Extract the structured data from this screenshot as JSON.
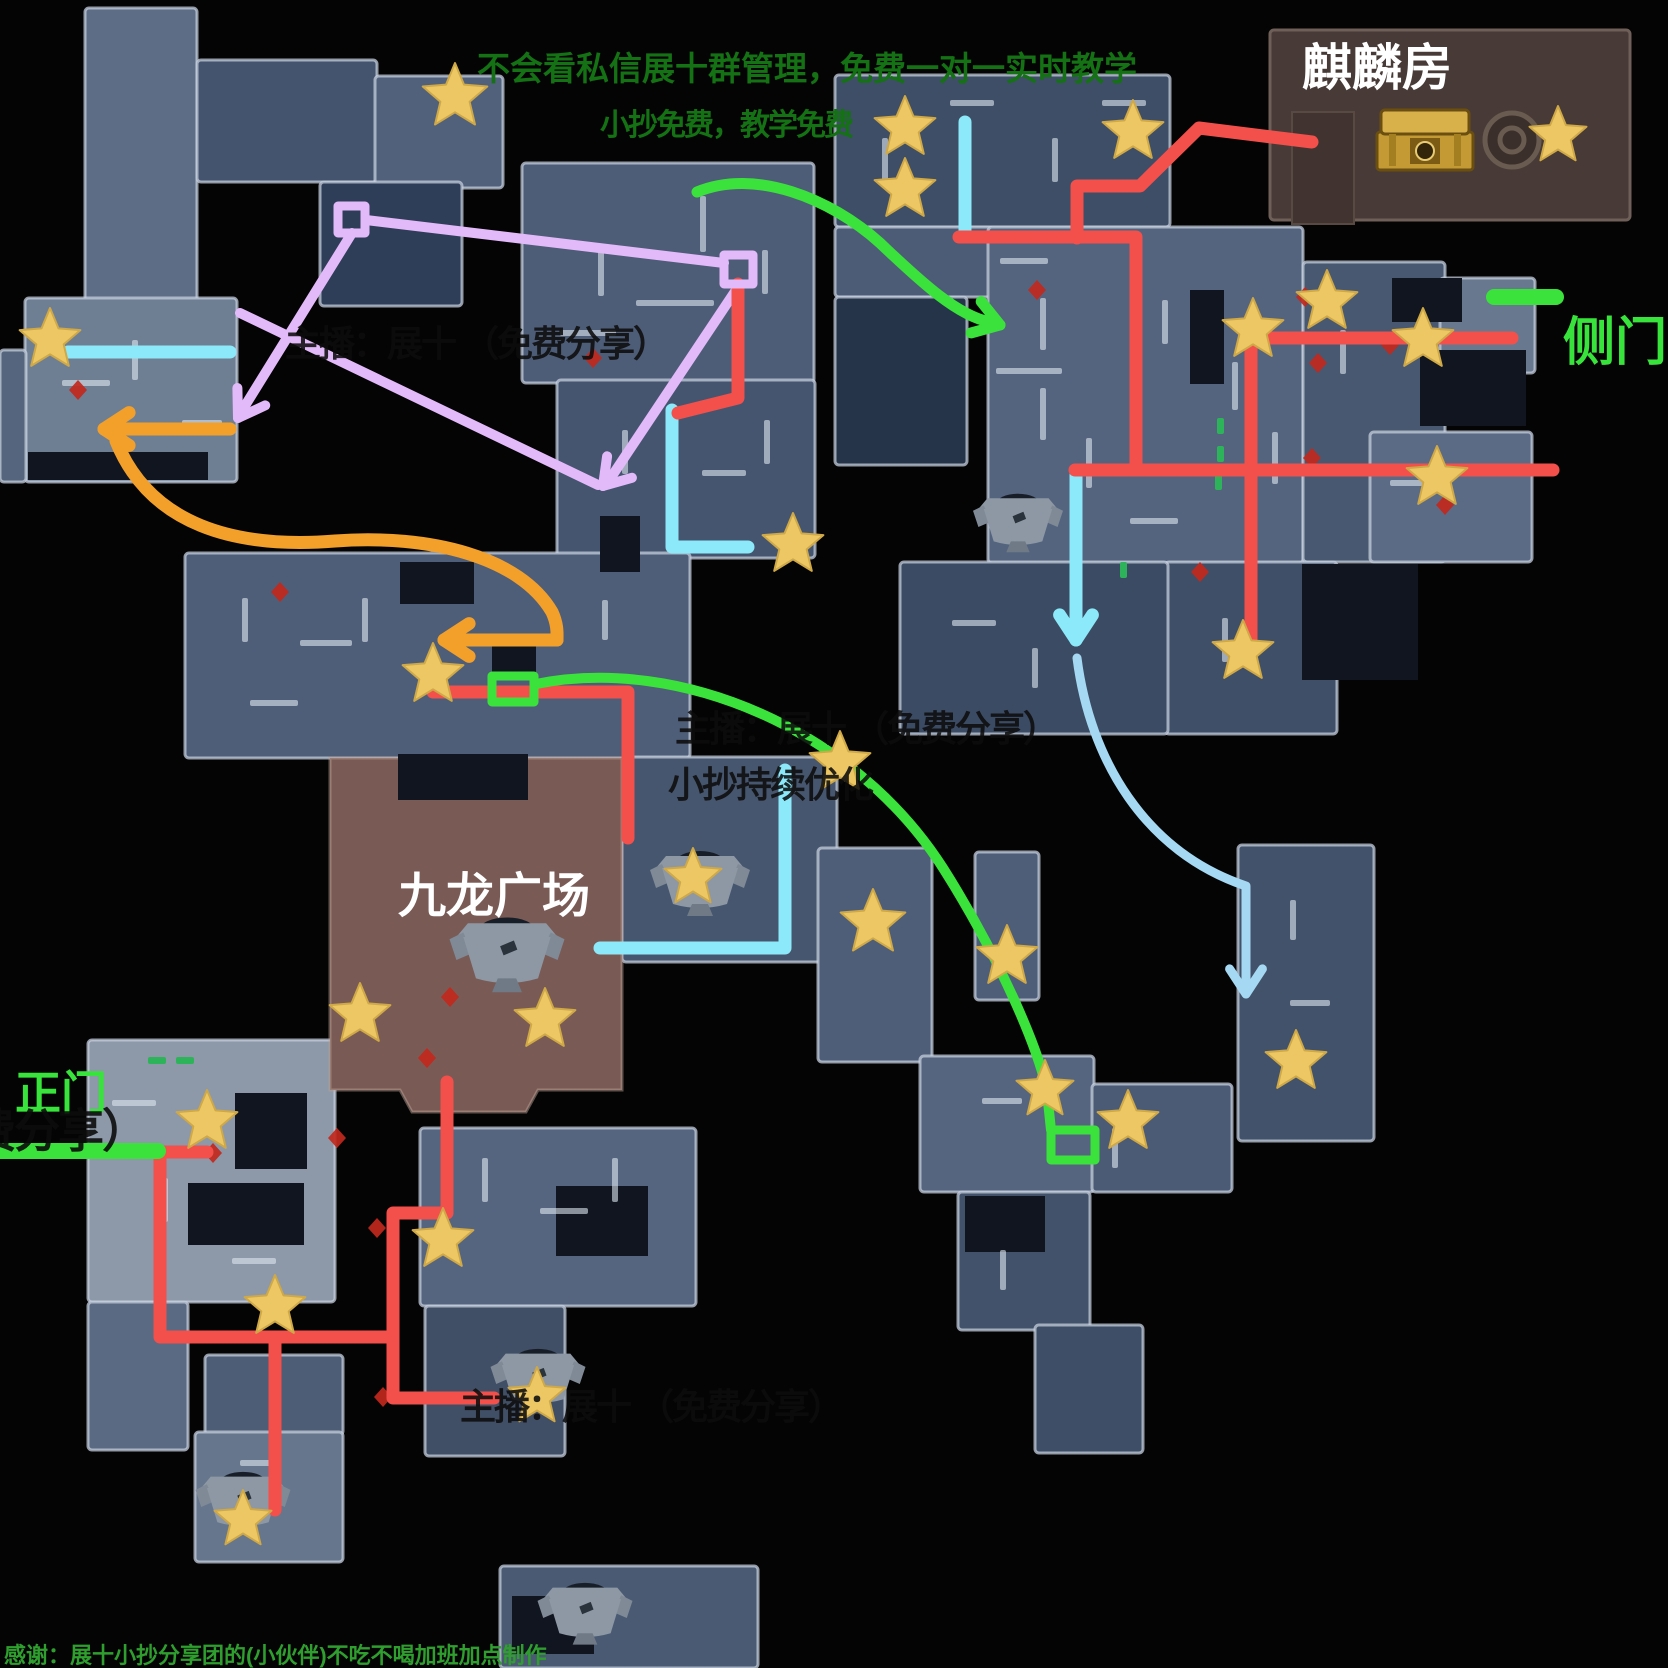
{
  "labels": {
    "top_notice_line1": "不会看私信展十群管理，免费一对一实时教学",
    "top_notice_line2": "小抄免费，教学免费",
    "qilin_room": "麒麟房",
    "side_door": "侧门",
    "main_door": "正门",
    "plaza": "九龙广场",
    "watermark": "主播：展十 （免费分享）",
    "watermark_line2": "小抄持续优化",
    "watermark_clipped": "费分享）",
    "thanks": "感谢：展十小抄分享团的(小伙伴)不吃不喝加班加点制作"
  },
  "colors": {
    "bg": "#040404",
    "wall": "rgba(196,206,220,0.75)",
    "tick": "rgba(222,230,240,0.6)",
    "patch": "#10151f",
    "plaza": "#7a5a55",
    "qilin": "#483a36",
    "red": "#f4504b",
    "cyan": "#8ce9f9",
    "lightblue": "#a5d8f3",
    "green": "#3be23b",
    "doorgreen": "#2db45a",
    "purple": "#e3baf9",
    "orange": "#f2a02a",
    "star": "#ecc763",
    "star_edge": "#cfa847",
    "diamond": "#c1281d",
    "gold": "#d9b14b"
  },
  "map": {
    "width": 1668,
    "height": 1668,
    "buildings": [
      [
        85,
        8,
        112,
        298,
        "#5d6d86"
      ],
      [
        197,
        60,
        180,
        122,
        "#44546e"
      ],
      [
        375,
        76,
        128,
        112,
        "#51617b"
      ],
      [
        320,
        182,
        142,
        124,
        "#2f3e58"
      ],
      [
        25,
        298,
        212,
        184,
        "#6e7f94"
      ],
      [
        0,
        350,
        26,
        132,
        "#55657d"
      ],
      [
        522,
        163,
        292,
        220,
        "#4d5d77"
      ],
      [
        557,
        380,
        258,
        178,
        "#45556f"
      ],
      [
        185,
        553,
        505,
        205,
        "#4e5e78"
      ],
      [
        622,
        757,
        215,
        205,
        "#46566e"
      ],
      [
        88,
        1040,
        247,
        262,
        "#8d99a8"
      ],
      [
        88,
        1302,
        100,
        148,
        "#5a6a82"
      ],
      [
        205,
        1355,
        138,
        80,
        "#4d5d75"
      ],
      [
        195,
        1432,
        148,
        130,
        "#66768c"
      ],
      [
        420,
        1128,
        276,
        178,
        "#55657f"
      ],
      [
        425,
        1306,
        140,
        150,
        "#414f66"
      ],
      [
        500,
        1566,
        258,
        102,
        "#4a5a72"
      ],
      [
        835,
        75,
        335,
        152,
        "#3e4e66"
      ],
      [
        835,
        227,
        158,
        70,
        "#4c5c76"
      ],
      [
        835,
        297,
        132,
        168,
        "#253449"
      ],
      [
        988,
        227,
        315,
        336,
        "#54647e"
      ],
      [
        1303,
        262,
        142,
        300,
        "#485870"
      ],
      [
        1440,
        278,
        95,
        95,
        "#68788e"
      ],
      [
        1370,
        432,
        162,
        130,
        "#5b6b85"
      ],
      [
        1165,
        562,
        172,
        172,
        "#3f4f67"
      ],
      [
        900,
        562,
        268,
        172,
        "#3b4b63"
      ],
      [
        1238,
        845,
        136,
        296,
        "#42526a"
      ],
      [
        818,
        848,
        114,
        214,
        "#4e5e78"
      ],
      [
        975,
        852,
        64,
        148,
        "#4e5e78"
      ],
      [
        920,
        1056,
        174,
        136,
        "#55657f"
      ],
      [
        1092,
        1084,
        140,
        108,
        "#4b5b75"
      ],
      [
        958,
        1192,
        132,
        138,
        "#42526a"
      ],
      [
        1035,
        1325,
        108,
        128,
        "#3e4e66"
      ]
    ],
    "plaza": {
      "d": "M330,758 L622,758 L622,1090 L538,1090 L526,1112 L412,1112 L400,1090 L330,1090 Z"
    },
    "qilin_box": [
      1270,
      30,
      360,
      190
    ],
    "qilin_shelf": [
      1292,
      112,
      62,
      112
    ],
    "dark_patches": [
      [
        398,
        754,
        130,
        46
      ],
      [
        235,
        1093,
        72,
        76
      ],
      [
        188,
        1183,
        116,
        62
      ],
      [
        556,
        1186,
        92,
        70
      ],
      [
        512,
        1596,
        82,
        58
      ],
      [
        1392,
        278,
        70,
        44
      ],
      [
        1190,
        290,
        34,
        94
      ],
      [
        600,
        516,
        40,
        56
      ],
      [
        400,
        562,
        74,
        42
      ],
      [
        28,
        452,
        180,
        28
      ],
      [
        1302,
        564,
        116,
        116
      ],
      [
        1420,
        350,
        106,
        76
      ],
      [
        492,
        645,
        44,
        28
      ],
      [
        965,
        1196,
        80,
        56
      ]
    ],
    "wall_ticks": [
      [
        598,
        248,
        6,
        48
      ],
      [
        636,
        300,
        78,
        6
      ],
      [
        700,
        196,
        6,
        56
      ],
      [
        560,
        330,
        56,
        6
      ],
      [
        762,
        250,
        6,
        44
      ],
      [
        1040,
        298,
        6,
        52
      ],
      [
        1040,
        388,
        6,
        52
      ],
      [
        996,
        368,
        66,
        6
      ],
      [
        1086,
        438,
        6,
        50
      ],
      [
        1162,
        300,
        6,
        44
      ],
      [
        1232,
        362,
        6,
        48
      ],
      [
        1130,
        518,
        48,
        6
      ],
      [
        1272,
        432,
        6,
        52
      ],
      [
        1000,
        258,
        48,
        6
      ],
      [
        242,
        598,
        6,
        44
      ],
      [
        300,
        640,
        52,
        6
      ],
      [
        362,
        598,
        6,
        44
      ],
      [
        480,
        640,
        48,
        6
      ],
      [
        602,
        600,
        6,
        40
      ],
      [
        250,
        700,
        48,
        6
      ],
      [
        482,
        1158,
        6,
        44
      ],
      [
        540,
        1208,
        48,
        6
      ],
      [
        612,
        1158,
        6,
        44
      ],
      [
        112,
        1100,
        44,
        6
      ],
      [
        162,
        1178,
        6,
        44
      ],
      [
        232,
        1258,
        44,
        6
      ],
      [
        882,
        138,
        6,
        44
      ],
      [
        950,
        100,
        44,
        6
      ],
      [
        1052,
        138,
        6,
        44
      ],
      [
        1102,
        100,
        44,
        6
      ],
      [
        62,
        380,
        48,
        6
      ],
      [
        132,
        340,
        6,
        40
      ],
      [
        182,
        420,
        40,
        6
      ],
      [
        622,
        430,
        6,
        44
      ],
      [
        702,
        470,
        44,
        6
      ],
      [
        764,
        420,
        6,
        44
      ],
      [
        952,
        620,
        44,
        6
      ],
      [
        1032,
        648,
        6,
        40
      ],
      [
        1222,
        618,
        6,
        44
      ],
      [
        982,
        1098,
        40,
        6
      ],
      [
        1112,
        1128,
        6,
        40
      ],
      [
        1000,
        1250,
        6,
        40
      ],
      [
        240,
        1460,
        40,
        6
      ],
      [
        1290,
        900,
        6,
        40
      ],
      [
        1290,
        1000,
        40,
        6
      ],
      [
        1340,
        330,
        6,
        44
      ],
      [
        1390,
        480,
        44,
        6
      ]
    ],
    "green_ticks": [
      [
        1217,
        418,
        7,
        16
      ],
      [
        1217,
        446,
        7,
        16
      ],
      [
        1215,
        474,
        7,
        16
      ],
      [
        1120,
        562,
        7,
        16
      ],
      [
        148,
        1057,
        18,
        7
      ],
      [
        176,
        1057,
        18,
        7
      ]
    ],
    "chests": [
      [
        507,
        960,
        1.15
      ],
      [
        700,
        888,
        1.0
      ],
      [
        1018,
        527,
        0.9
      ],
      [
        538,
        1384,
        0.95
      ],
      [
        243,
        1507,
        0.95
      ],
      [
        585,
        1618,
        0.95
      ]
    ],
    "gold_chest": [
      1425,
      142
    ],
    "circle_icon": [
      1512,
      140
    ],
    "diamonds": [
      [
        78,
        390
      ],
      [
        593,
        358
      ],
      [
        280,
        592
      ],
      [
        427,
        1058
      ],
      [
        213,
        1153
      ],
      [
        337,
        1138
      ],
      [
        377,
        1228
      ],
      [
        383,
        1397
      ],
      [
        1037,
        290
      ],
      [
        1305,
        297
      ],
      [
        1318,
        363
      ],
      [
        1312,
        458
      ],
      [
        1200,
        572
      ],
      [
        1390,
        345
      ],
      [
        1445,
        505
      ],
      [
        450,
        997
      ]
    ],
    "routes": [
      {
        "name": "purple-line-1",
        "color": "purple",
        "w": 10,
        "pts": [
          [
            366,
            220
          ],
          [
            724,
            263
          ]
        ]
      },
      {
        "name": "purple-arrow-left",
        "color": "purple",
        "w": 10,
        "pts": [
          [
            352,
            233
          ],
          [
            243,
            409
          ]
        ],
        "head": {
          "x": 238,
          "y": 418,
          "a": 122
        }
      },
      {
        "name": "purple-diagonal",
        "color": "purple",
        "w": 10,
        "pts": [
          [
            240,
            313
          ],
          [
            598,
            485
          ]
        ]
      },
      {
        "name": "purple-arrow-2",
        "color": "purple",
        "w": 10,
        "pts": [
          [
            736,
            290
          ],
          [
            610,
            479
          ]
        ],
        "head": {
          "x": 603,
          "y": 486,
          "a": 131
        }
      },
      {
        "name": "orange-arrow-1",
        "color": "orange",
        "w": 13,
        "pts": [
          [
            230,
            429
          ],
          [
            112,
            429
          ]
        ],
        "head": {
          "x": 104,
          "y": 429,
          "a": 180
        }
      },
      {
        "name": "orange-curve",
        "color": "orange",
        "w": 13,
        "d": "M116,441 C150,525 235,549 335,541 C430,534 520,557 552,612 C558,625 557,634 557,640"
      },
      {
        "name": "orange-arrow-2",
        "color": "orange",
        "w": 13,
        "pts": [
          [
            557,
            640
          ],
          [
            452,
            640
          ]
        ],
        "head": {
          "x": 444,
          "y": 640,
          "a": 180
        }
      },
      {
        "name": "cyan-line-left",
        "color": "cyan",
        "w": 13,
        "pts": [
          [
            68,
            352
          ],
          [
            230,
            352
          ]
        ]
      },
      {
        "name": "cyan-elbow-mid",
        "color": "cyan",
        "w": 13,
        "pts": [
          [
            672,
            410
          ],
          [
            672,
            547
          ],
          [
            748,
            547
          ]
        ]
      },
      {
        "name": "cyan-elbow-plaza",
        "color": "cyan",
        "w": 13,
        "pts": [
          [
            785,
            770
          ],
          [
            785,
            948
          ],
          [
            600,
            948
          ]
        ]
      },
      {
        "name": "cyan-line-right-top",
        "color": "cyan",
        "w": 13,
        "pts": [
          [
            965,
            122
          ],
          [
            965,
            235
          ]
        ]
      },
      {
        "name": "cyan-arrow-down",
        "color": "cyan",
        "w": 13,
        "pts": [
          [
            1076,
            475
          ],
          [
            1076,
            628
          ]
        ],
        "head": {
          "x": 1076,
          "y": 640,
          "a": 90
        }
      },
      {
        "name": "blue-curve-arrow",
        "color": "lightblue",
        "w": 9,
        "d": "M1077,658 C1090,760 1145,852 1246,886 L1246,982",
        "head": {
          "x": 1246,
          "y": 994,
          "a": 90
        }
      },
      {
        "name": "red-route-mid",
        "color": "red",
        "w": 13,
        "pts": [
          [
            738,
            284
          ],
          [
            738,
            398
          ],
          [
            678,
            413
          ]
        ]
      },
      {
        "name": "red-route-plaza-top",
        "color": "red",
        "w": 13,
        "pts": [
          [
            433,
            692
          ],
          [
            628,
            692
          ],
          [
            628,
            838
          ]
        ]
      },
      {
        "name": "red-route-plaza",
        "color": "red",
        "w": 13,
        "pts": [
          [
            447,
            1082
          ],
          [
            447,
            1213
          ],
          [
            393,
            1213
          ],
          [
            393,
            1398
          ],
          [
            494,
            1398
          ]
        ]
      },
      {
        "name": "red-stub-gate",
        "color": "red",
        "w": 13,
        "pts": [
          [
            160,
            1152
          ],
          [
            207,
            1152
          ]
        ]
      },
      {
        "name": "red-route-left",
        "color": "red",
        "w": 13,
        "pts": [
          [
            160,
            1152
          ],
          [
            160,
            1337
          ],
          [
            386,
            1337
          ]
        ]
      },
      {
        "name": "red-branch-down",
        "color": "red",
        "w": 13,
        "pts": [
          [
            275,
            1337
          ],
          [
            275,
            1510
          ]
        ]
      },
      {
        "name": "red-route-qilin",
        "color": "red",
        "w": 13,
        "pts": [
          [
            1312,
            142
          ],
          [
            1199,
            128
          ],
          [
            1140,
            186
          ],
          [
            1077,
            186
          ],
          [
            1077,
            238
          ]
        ]
      },
      {
        "name": "red-route-right-1",
        "color": "red",
        "w": 13,
        "pts": [
          [
            959,
            237
          ],
          [
            1136,
            237
          ],
          [
            1136,
            466
          ]
        ]
      },
      {
        "name": "red-route-right-2",
        "color": "red",
        "w": 13,
        "pts": [
          [
            1075,
            470
          ],
          [
            1553,
            470
          ]
        ]
      },
      {
        "name": "red-route-side-door",
        "color": "red",
        "w": 13,
        "pts": [
          [
            1248,
            338
          ],
          [
            1512,
            338
          ]
        ]
      },
      {
        "name": "red-route-right-vert",
        "color": "red",
        "w": 13,
        "pts": [
          [
            1251,
            325
          ],
          [
            1251,
            650
          ]
        ]
      },
      {
        "name": "green-curve-arrow-top",
        "color": "green",
        "w": 11,
        "d": "M697,192 C755,168 830,198 880,243 C922,283 958,316 990,322",
        "head": {
          "x": 1000,
          "y": 325,
          "a": 18
        }
      },
      {
        "name": "green-curve-long",
        "color": "green",
        "w": 10,
        "d": "M536,684 C680,655 855,730 943,868 C1000,958 1040,1052 1047,1092 L1051,1130"
      },
      {
        "name": "green-door-side",
        "color": "green",
        "w": 16,
        "pts": [
          [
            1494,
            297
          ],
          [
            1556,
            297
          ]
        ]
      },
      {
        "name": "green-door-main",
        "color": "green",
        "w": 16,
        "pts": [
          [
            0,
            1151
          ],
          [
            158,
            1151
          ]
        ]
      }
    ],
    "purple_squares": [
      [
        338,
        206,
        27,
        27
      ],
      [
        724,
        255,
        29,
        29
      ]
    ],
    "green_squares": [
      [
        1051,
        1130,
        44,
        30
      ],
      [
        492,
        676,
        42,
        26
      ]
    ],
    "stars": [
      [
        455,
        97,
        34
      ],
      [
        50,
        340
      ],
      [
        793,
        545
      ],
      [
        433,
        675
      ],
      [
        905,
        128
      ],
      [
        905,
        190
      ],
      [
        1133,
        132
      ],
      [
        1558,
        136,
        30
      ],
      [
        1253,
        330
      ],
      [
        1327,
        302
      ],
      [
        1423,
        340
      ],
      [
        1437,
        478
      ],
      [
        1243,
        652
      ],
      [
        840,
        763
      ],
      [
        873,
        923,
        34
      ],
      [
        1007,
        957
      ],
      [
        1045,
        1090,
        30
      ],
      [
        1128,
        1122
      ],
      [
        1296,
        1062
      ],
      [
        693,
        878,
        30
      ],
      [
        360,
        1015
      ],
      [
        545,
        1020
      ],
      [
        207,
        1122
      ],
      [
        275,
        1307
      ],
      [
        443,
        1240
      ],
      [
        537,
        1397,
        30
      ],
      [
        243,
        1520,
        30
      ]
    ]
  }
}
